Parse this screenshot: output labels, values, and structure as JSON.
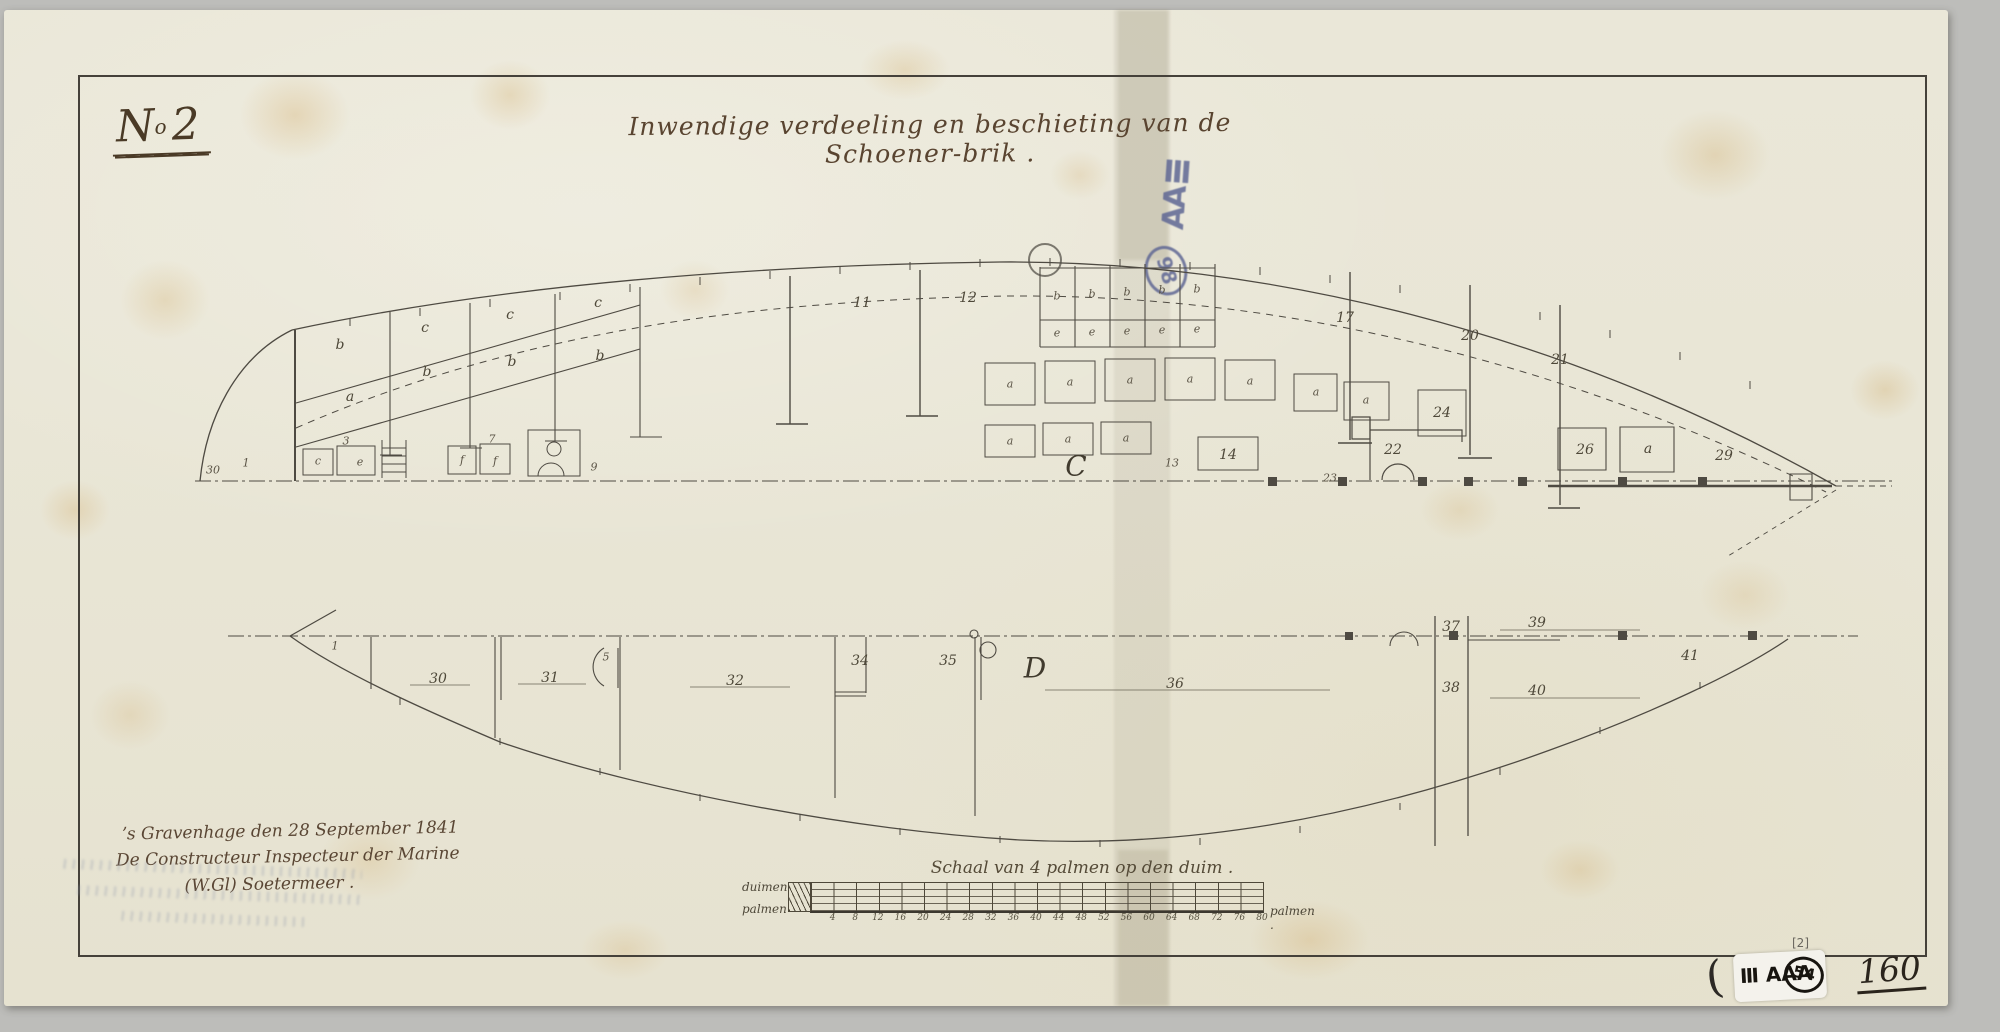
{
  "document": {
    "sheet_number": {
      "prefix": "N",
      "sup": "o",
      "number": "2"
    },
    "title": "Inwendige verdeeling en beschieting van de Schoener-brik .",
    "signature": {
      "line1": "ʼs Gravenhage den 28 September 1841",
      "line2": "De Constructeur Inspecteur der Marine",
      "line3": "(W.Gl) Soetermeer ."
    },
    "folio_number": "160"
  },
  "stamps": {
    "blue_stamp": {
      "text": "AAⅢ",
      "circle": "98",
      "color": "#5f6794"
    },
    "catalog_sticker": {
      "annotation": "[2]",
      "paren": "(",
      "text": "Ⅲ AAA",
      "circle": "54"
    }
  },
  "scale_bar": {
    "title": "Schaal van 4 palmen op den duim .",
    "unit_top_left": "duimen",
    "unit_bottom_left": "palmen",
    "unit_right": "palmen .",
    "tick_labels": [
      "4",
      "8",
      "12",
      "16",
      "20",
      "24",
      "28",
      "32",
      "36",
      "40",
      "44",
      "48",
      "52",
      "56",
      "60",
      "64",
      "68",
      "72",
      "76",
      "80"
    ]
  },
  "upper_view": {
    "labels": [
      {
        "t": "b",
        "x": 340,
        "y": 345
      },
      {
        "t": "c",
        "x": 425,
        "y": 328
      },
      {
        "t": "b",
        "x": 427,
        "y": 372
      },
      {
        "t": "c",
        "x": 510,
        "y": 315
      },
      {
        "t": "b",
        "x": 512,
        "y": 362
      },
      {
        "t": "c",
        "x": 598,
        "y": 303
      },
      {
        "t": "b",
        "x": 600,
        "y": 356
      },
      {
        "t": "a",
        "x": 350,
        "y": 397
      },
      {
        "t": "11",
        "x": 862,
        "y": 303
      },
      {
        "t": "12",
        "x": 968,
        "y": 298
      },
      {
        "t": "b",
        "x": 1057,
        "y": 296,
        "s": "sm"
      },
      {
        "t": "b",
        "x": 1092,
        "y": 294,
        "s": "sm"
      },
      {
        "t": "b",
        "x": 1127,
        "y": 292,
        "s": "sm"
      },
      {
        "t": "b",
        "x": 1162,
        "y": 290,
        "s": "sm"
      },
      {
        "t": "b",
        "x": 1197,
        "y": 289,
        "s": "sm"
      },
      {
        "t": "e",
        "x": 1057,
        "y": 333,
        "s": "sm"
      },
      {
        "t": "e",
        "x": 1092,
        "y": 332,
        "s": "sm"
      },
      {
        "t": "e",
        "x": 1127,
        "y": 331,
        "s": "sm"
      },
      {
        "t": "e",
        "x": 1162,
        "y": 330,
        "s": "sm"
      },
      {
        "t": "e",
        "x": 1197,
        "y": 329,
        "s": "sm"
      },
      {
        "t": "17",
        "x": 1345,
        "y": 318
      },
      {
        "t": "20",
        "x": 1470,
        "y": 336
      },
      {
        "t": "21",
        "x": 1560,
        "y": 360
      },
      {
        "t": "24",
        "x": 1442,
        "y": 413
      },
      {
        "t": "a",
        "x": 1010,
        "y": 384,
        "s": "sm"
      },
      {
        "t": "a",
        "x": 1070,
        "y": 382,
        "s": "sm"
      },
      {
        "t": "a",
        "x": 1130,
        "y": 380,
        "s": "sm"
      },
      {
        "t": "a",
        "x": 1190,
        "y": 379,
        "s": "sm"
      },
      {
        "t": "a",
        "x": 1250,
        "y": 381,
        "s": "sm"
      },
      {
        "t": "a",
        "x": 1316,
        "y": 392,
        "s": "sm"
      },
      {
        "t": "a",
        "x": 1366,
        "y": 400,
        "s": "sm"
      },
      {
        "t": "a",
        "x": 1010,
        "y": 441,
        "s": "sm"
      },
      {
        "t": "a",
        "x": 1068,
        "y": 439,
        "s": "sm"
      },
      {
        "t": "a",
        "x": 1126,
        "y": 438,
        "s": "sm"
      },
      {
        "t": "C",
        "x": 1076,
        "y": 466,
        "s": "lg"
      },
      {
        "t": "13",
        "x": 1172,
        "y": 463,
        "s": "sm"
      },
      {
        "t": "14",
        "x": 1228,
        "y": 455
      },
      {
        "t": "22",
        "x": 1393,
        "y": 450
      },
      {
        "t": "26",
        "x": 1585,
        "y": 450
      },
      {
        "t": "a",
        "x": 1648,
        "y": 449
      },
      {
        "t": "29",
        "x": 1724,
        "y": 456
      },
      {
        "t": "30",
        "x": 213,
        "y": 470,
        "s": "sm"
      },
      {
        "t": "1",
        "x": 246,
        "y": 463,
        "s": "sm"
      },
      {
        "t": "c",
        "x": 318,
        "y": 461,
        "s": "sm"
      },
      {
        "t": "3",
        "x": 346,
        "y": 441,
        "s": "sm"
      },
      {
        "t": "e",
        "x": 360,
        "y": 462,
        "s": "sm"
      },
      {
        "t": "f",
        "x": 462,
        "y": 460,
        "s": "sm"
      },
      {
        "t": "7",
        "x": 492,
        "y": 439,
        "s": "sm"
      },
      {
        "t": "f",
        "x": 495,
        "y": 461,
        "s": "sm"
      },
      {
        "t": "9",
        "x": 594,
        "y": 467,
        "s": "sm"
      },
      {
        "t": "23",
        "x": 1330,
        "y": 478,
        "s": "sm"
      }
    ]
  },
  "lower_view": {
    "labels": [
      {
        "t": "1",
        "x": 335,
        "y": 646,
        "s": "sm"
      },
      {
        "t": "30",
        "x": 438,
        "y": 679
      },
      {
        "t": "31",
        "x": 550,
        "y": 678
      },
      {
        "t": "5",
        "x": 606,
        "y": 657,
        "s": "sm"
      },
      {
        "t": "32",
        "x": 735,
        "y": 681
      },
      {
        "t": "34",
        "x": 860,
        "y": 661
      },
      {
        "t": "35",
        "x": 948,
        "y": 661
      },
      {
        "t": "D",
        "x": 1035,
        "y": 668,
        "s": "lg"
      },
      {
        "t": "36",
        "x": 1175,
        "y": 684
      },
      {
        "t": "37",
        "x": 1451,
        "y": 627
      },
      {
        "t": "39",
        "x": 1537,
        "y": 623
      },
      {
        "t": "38",
        "x": 1451,
        "y": 688
      },
      {
        "t": "40",
        "x": 1537,
        "y": 691
      },
      {
        "t": "41",
        "x": 1690,
        "y": 656
      }
    ]
  }
}
